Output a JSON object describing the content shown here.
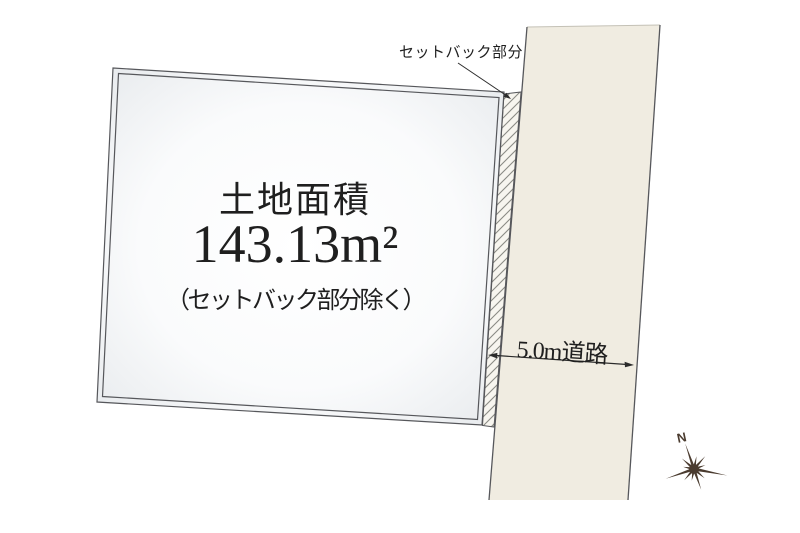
{
  "labels": {
    "setback": "セットバック部分",
    "area_title": "土地面積",
    "area_value": "143.13m²",
    "area_note": "（セットバック部分除く）",
    "road": "5.0m道路",
    "compass_north": "N"
  },
  "colors": {
    "road_fill": "#F0ECE1",
    "plot_fill_center": "#FFFFFF",
    "plot_fill_edge": "#E6E9EC",
    "outline": "#56575B",
    "hatch": "#8A8A84",
    "arrow": "#2B2B2B",
    "text": "#1F1F1F",
    "compass": "#4A3B2F"
  }
}
